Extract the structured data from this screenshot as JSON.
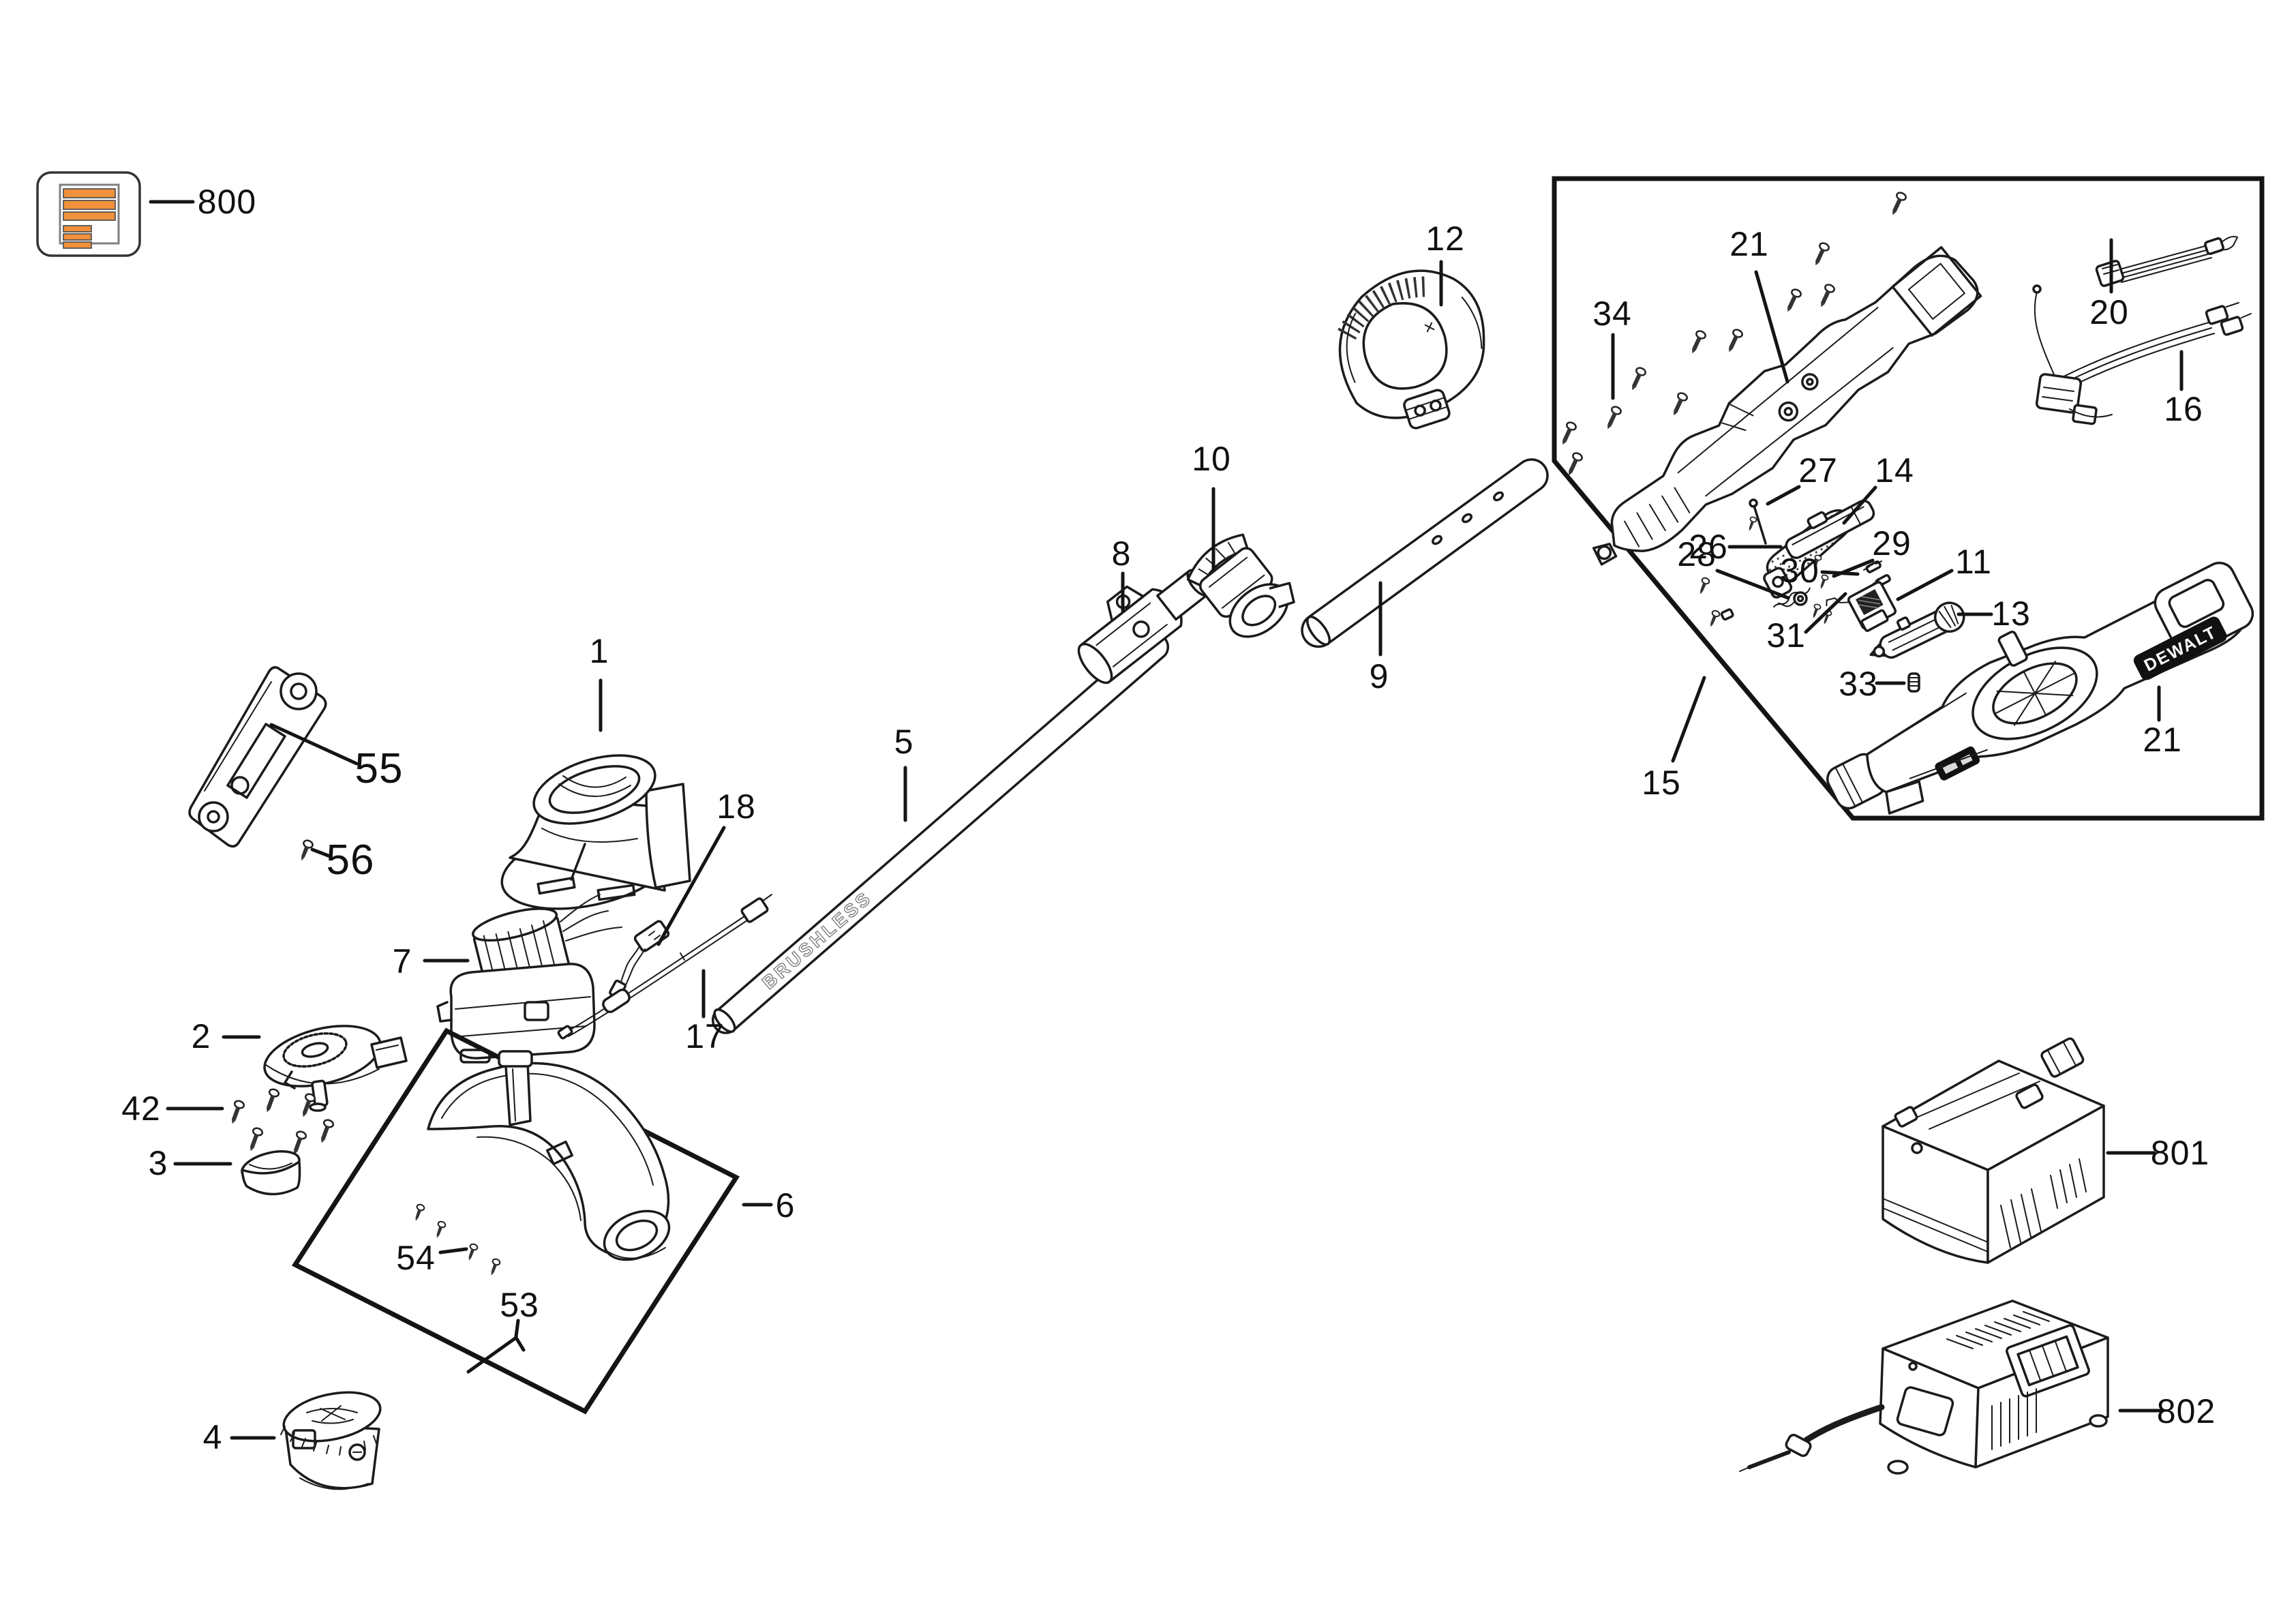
{
  "diagram": {
    "kind": "exploded-parts-diagram",
    "background": "#ffffff"
  },
  "labels": {
    "p800": "800",
    "p12": "12",
    "p10": "10",
    "p8": "8",
    "p9": "9",
    "p5": "5",
    "p18": "18",
    "p1": "1",
    "p55": "55",
    "p56": "56",
    "p7": "7",
    "p17": "17",
    "p2": "2",
    "p42": "42",
    "p3": "3",
    "p4": "4",
    "p53": "53",
    "p54": "54",
    "p6": "6",
    "p34": "34",
    "p21a": "21",
    "p27": "27",
    "p14": "14",
    "p28": "28",
    "p29": "29",
    "p26": "26",
    "p30": "30",
    "p31": "31",
    "p11": "11",
    "p13": "13",
    "p33": "33",
    "p21b": "21",
    "p20": "20",
    "p16": "16",
    "p15": "15",
    "p801": "801",
    "p802": "802"
  },
  "texts": {
    "shaft_marking": "BRUSHLESS",
    "brand_badge": "DEWALT"
  },
  "icons": {
    "manual_icon": "parts-manual-document"
  },
  "colors": {
    "line": "#1b1b1b",
    "accent_orange": "#F0913B",
    "badge_black": "#111111",
    "background": "#ffffff"
  }
}
